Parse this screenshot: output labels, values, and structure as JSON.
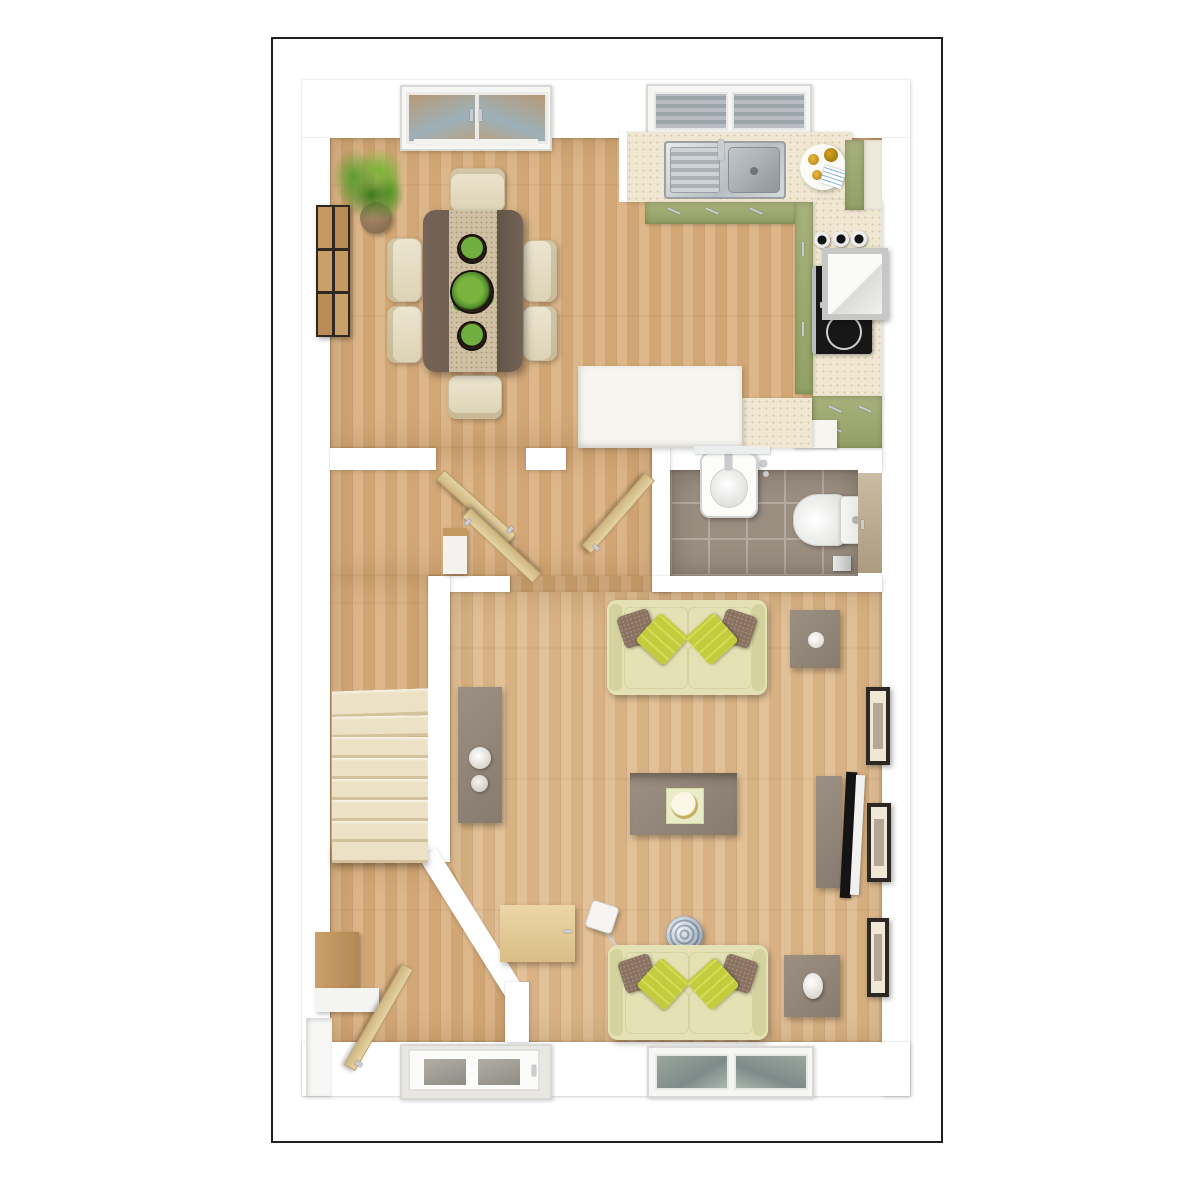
{
  "meta": {
    "kind": "3d-floor-plan-render",
    "view": "top-down",
    "floor": "ground-floor"
  },
  "palette": {
    "page": "#ffffff",
    "frame": "#1f1f1f",
    "wall": "#ffffff",
    "woodMain": "#d9ae7c",
    "woodLight": "#e0ba8c",
    "tile": "#9a8e81",
    "grout": "#b5aa9d",
    "counter": "#efe7d2",
    "cabinetGreen": "#a8b17c",
    "cabinetGreenDark": "#93a065",
    "steel": "#c9cdd0",
    "hob": "#171717",
    "sofa": "#e4e2b4",
    "sofaEdge": "#d4d29e",
    "cushionLime": "#c3cc3d",
    "pillowBrown": "#8a7261",
    "tableGray": "#9c9083",
    "tableGrayDark": "#877b6e",
    "tableDark": "#6e5f52",
    "runner": "#cfc0a4",
    "chair": "#ece5cf",
    "chairEdge": "#c9bd9e",
    "stairs": "#ece1c4",
    "stairEdge": "#d3c29d",
    "doorLeaf": "#e6d2a5",
    "wcDoor": "#cbbda4",
    "artWood": "#c49a62",
    "plantGreen": "#5c9c33",
    "plantDark": "#3f7a22",
    "pot": "#8a6f52",
    "lampWhite": "#f4f2ec",
    "glassBlue": "#99a5a8",
    "gold": "#c6ae62"
  },
  "scene": {
    "rooms": [
      {
        "name": "kitchen-dining",
        "floor": "wood",
        "items": [
          "french-doors",
          "kitchen-window",
          "potted-plant",
          "wood-wall-art",
          "dining-table",
          "table-planters-3",
          "dining-chairs-6",
          "sink-counter",
          "double-sink",
          "breakfast-tray",
          "green-base-cabinets",
          "tall-units",
          "hob",
          "cooker-hood",
          "canisters-3",
          "green-drawer-unit",
          "white-peninsula"
        ]
      },
      {
        "name": "hallway",
        "floor": "wood",
        "items": [
          "dining-door-open",
          "kitchen-door-open",
          "living-door-open",
          "hall-cabinet"
        ]
      },
      {
        "name": "wc",
        "floor": "tile",
        "items": [
          "basin",
          "chrome-tap",
          "toilet",
          "cistern",
          "toilet-roll-holder",
          "wc-door-closed"
        ]
      },
      {
        "name": "stair-corridor",
        "floor": "wood",
        "items": [
          "staircase-7-steps"
        ]
      },
      {
        "name": "entrance-hall",
        "floor": "wood",
        "items": [
          "front-door-glazed",
          "console-table",
          "open-door-leaf",
          "wall-niche"
        ]
      },
      {
        "name": "living-room",
        "floor": "wood",
        "items": [
          "sofa-upper",
          "sofa-lower",
          "coffee-table",
          "candle-tray",
          "side-table-upper",
          "side-table-lower",
          "egg-lamp",
          "sideboard",
          "decor-bowls-2",
          "tv-unit",
          "flat-tv",
          "picture-frames-3",
          "floor-lamp-sphere",
          "lamp-cord",
          "lamp-switch",
          "nook-desk",
          "living-window",
          "diagonal-wall"
        ]
      }
    ]
  }
}
